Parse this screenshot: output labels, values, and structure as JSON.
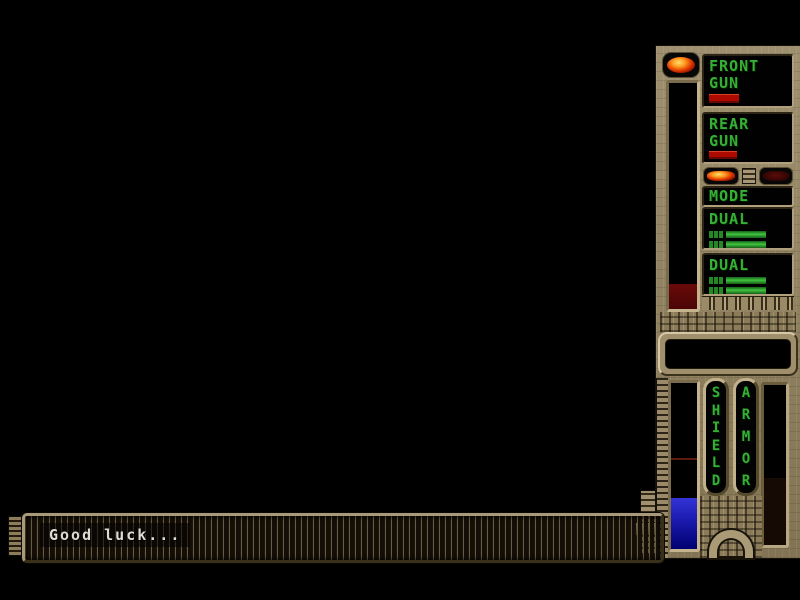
{
  "sidebar": {
    "weapons": {
      "front_gun_line1": "FRONT",
      "front_gun_line2": "GUN",
      "rear_gun_line1": "REAR",
      "rear_gun_line2": "GUN",
      "mode_label": "MODE",
      "dual_primary_label": "DUAL",
      "dual_secondary_label": "DUAL"
    },
    "status": {
      "shield_label": "SHIELD",
      "armor_label": "ARMOR",
      "shield_fill_percent": 31,
      "armor_fill_percent": 0,
      "energy_fill_percent": 11
    },
    "colors": {
      "led_green": "#35b035",
      "ammo_red": "#ad0b00",
      "shield_blue": "#2a2ac8",
      "energy_red_dim": "#5c0908",
      "panel_tan": "#94845f"
    }
  },
  "message_bar": {
    "text": "Good luck..."
  }
}
